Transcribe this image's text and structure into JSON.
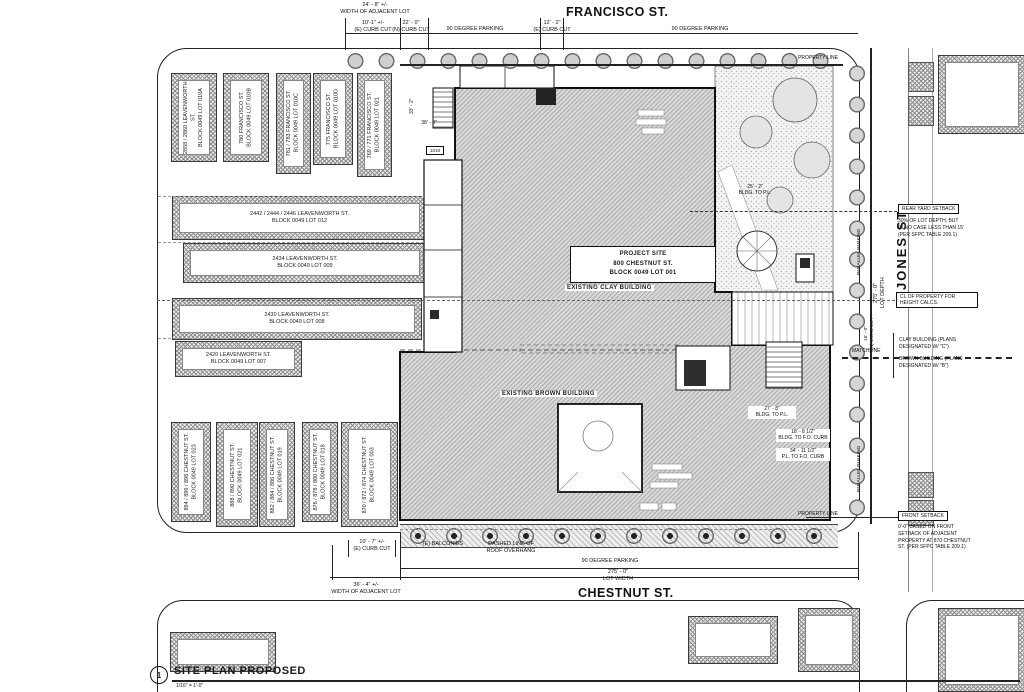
{
  "streets": {
    "francisco": "FRANCISCO ST.",
    "chestnut": "CHESTNUT ST.",
    "jones": "JONES ST."
  },
  "title_block": {
    "number": "1",
    "title": "SITE PLAN PROPOSED",
    "scale": "1/16\" = 1'-0\""
  },
  "site": {
    "box": "PROJECT SITE\n800 CHESTNUT ST.\nBLOCK 0049 LOT 001",
    "clay": "EXISTING CLAY BUILDING",
    "brown": "EXISTING BROWN BUILDING",
    "keynote": "1018"
  },
  "dims_top": {
    "adjacent_lot": "24' - 8\" +/-\nWIDTH OF ADJACENT LOT",
    "e_curb_cut": "10'-1\" +/-\n(E) CURB CUT",
    "n_curb_cut": "22' - 0\"\n(N) CURB CUT",
    "parking_left": "90 DEGREE PARKING",
    "e_curb_cut2": "12' - 2\"\n(E) CURB CUT",
    "parking_right": "90 DEGREE PARKING",
    "property_line": "PROPERTY LINE"
  },
  "dims_bottom": {
    "balconies": "(E) BALCONIES",
    "roof_overhang": "DASHED LINE OF\nROOF OVERHANG",
    "parking": "90 DEGREE PARKING",
    "lot_width": "275' - 0\"\nLOT WIDTH",
    "e_curb_cut": "10' - 7\" +/-\n(E) CURB CUT",
    "adjacent_lot": "36' - 4\" +/-\nWIDTH OF ADJACENT LOT",
    "property_line": "PROPERTY LINE"
  },
  "right_side": {
    "rear_setback_title": "REAR YARD SETBACK",
    "rear_setback_note": "30% OF LOT DEPTH, BUT\nIN NO CASE LESS THAN 15'\n(PER SFPC TABLE 209.1)",
    "cl_note": "CL OF PROPERTY FOR\nHEIGHT CALCS.",
    "clay_note": "CLAY BUILDING (PLANS\nDESIGNATED W/ \"C\")",
    "brown_note": "BROWN BUILDING (PLANS\nDESIGNATED W/ \"B\")",
    "front_setback_title": "FRONT SETBACK",
    "front_setback_note": "0'-0\" BASED ON FRONT\nSETBACK OF ADJACENT\nPROPERTY AT 870 CHESTNUT\nST. (PER SFPC TABLE 209.1)",
    "parallel_parking": "PARALLEL PARKING",
    "lot_depth": "275' - 0\"\nLOT DEPTH",
    "n_curb_cut": "16' - 0\"\n(N) CURB CUT",
    "matchline": "MATCHLINE",
    "bldg_to_pl": "25' - 2\"\nBLDG. TO P.L.",
    "dim_bldg_pl2": "27' - 8\"\nBLDG. TO P.L.",
    "dim_bldg_curb": "18' - 8 1/2\"\nBLDG. TO F.O. CURB",
    "dim_pl_curb": "34' - 11 1/2\"\nP.L. TO F.O. CURB",
    "dim_33": "33' - 2\"",
    "dim_38": "38' - 0\""
  },
  "neighbors": {
    "top": [
      {
        "label": "2858 / 2860 LEAVENWORTH ST.\nBLOCK 0049 LOT 010A"
      },
      {
        "label": "780 FRANCISCO ST.\nBLOCK 0049 LOT 010B"
      },
      {
        "label": "781 / 783 FRANCISCO ST.\nBLOCK 0049 LOT 010C"
      },
      {
        "label": "775 FRANCISCO ST.\nBLOCK 0049 LOT 010D"
      },
      {
        "label": "769 / 771 FRANCISCO ST.\nBLOCK 0049 LOT 021"
      }
    ],
    "mid": [
      {
        "label": "2442 / 2444 / 2446 LEAVENWORTH ST.\nBLOCK 0049 LOT 012"
      },
      {
        "label": "2434 LEAVENWORTH ST.\nBLOCK 0049 LOT 009"
      },
      {
        "label": "2430 LEAVENWORTH ST.\nBLOCK 0049 LOT 008"
      },
      {
        "label": "2420 LEAVENWORTH ST.\nBLOCK 0049 LOT 007"
      }
    ],
    "bottom": [
      {
        "label": "894 / 896 / 898 CHESTNUT ST.\nBLOCK 0049 LOT 023"
      },
      {
        "label": "888 / 890 CHESTNUT ST.\nBLOCK 0049 LOT 021"
      },
      {
        "label": "882 / 884 / 886 CHESTNUT ST.\nBLOCK 0049 LOT 019"
      },
      {
        "label": "876 / 878 / 880 CHESTNUT ST.\nBLOCK 0049 LOT 018"
      },
      {
        "label": "870 / 872 / 874 CHESTNUT ST.\nBLOCK 0049 LOT 003"
      }
    ]
  },
  "colors": {
    "line": "#1a1a1a",
    "hatch": "#8f8f8f",
    "paper": "#ffffff"
  }
}
